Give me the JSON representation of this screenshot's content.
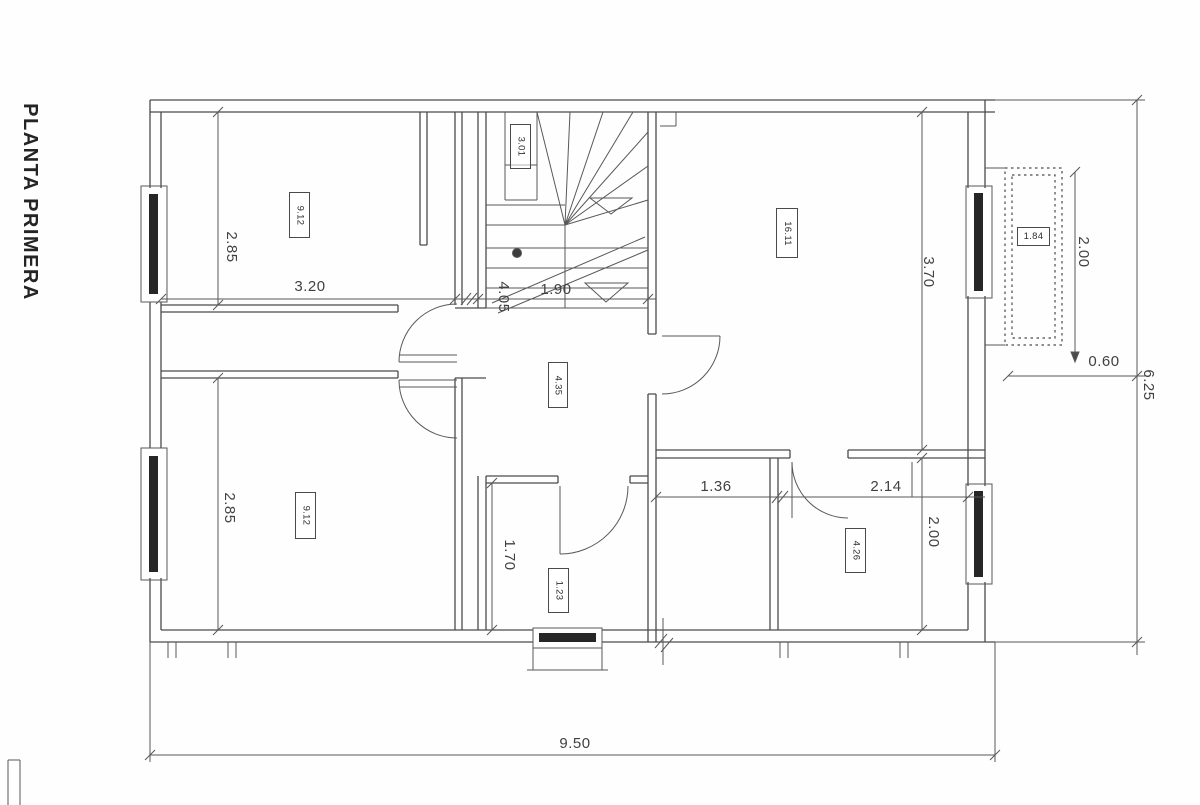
{
  "title": "PLANTA PRIMERA",
  "colors": {
    "line": "#4b4b4b",
    "text": "#414141",
    "background": "#fefefe"
  },
  "dimensions": [
    {
      "id": "top-left-room-height",
      "value": "2.85",
      "orient": "vertical"
    },
    {
      "id": "top-left-room-width",
      "value": "3.20",
      "orient": "horizontal"
    },
    {
      "id": "hall-depth",
      "value": "4.05",
      "orient": "vertical"
    },
    {
      "id": "stair-width",
      "value": "1.90",
      "orient": "horizontal"
    },
    {
      "id": "top-right-room-height",
      "value": "3.70",
      "orient": "vertical"
    },
    {
      "id": "balcony-height",
      "value": "2.00",
      "orient": "vertical"
    },
    {
      "id": "balcony-offset",
      "value": "0.60",
      "orient": "horizontal"
    },
    {
      "id": "overall-height",
      "value": "6.25",
      "orient": "vertical"
    },
    {
      "id": "corridor-width",
      "value": "1.36",
      "orient": "horizontal"
    },
    {
      "id": "right-bath-width",
      "value": "2.14",
      "orient": "horizontal"
    },
    {
      "id": "right-bath-height",
      "value": "2.00",
      "orient": "vertical"
    },
    {
      "id": "center-bath-height",
      "value": "1.70",
      "orient": "vertical"
    },
    {
      "id": "bottom-left-room-height",
      "value": "2.85",
      "orient": "vertical"
    },
    {
      "id": "overall-width",
      "value": "9.50",
      "orient": "horizontal"
    }
  ],
  "room_labels": [
    {
      "id": "bedroom-top-left",
      "value": "9.12"
    },
    {
      "id": "room-top-right",
      "value": "16.11"
    },
    {
      "id": "hall-center",
      "value": "4.35"
    },
    {
      "id": "bedroom-bottom-left",
      "value": "9.12"
    },
    {
      "id": "bath-center",
      "value": "1.23"
    },
    {
      "id": "bath-right",
      "value": "4.26"
    },
    {
      "id": "balcony",
      "value": "1.84"
    },
    {
      "id": "stair-closet",
      "value": "3.01"
    }
  ]
}
